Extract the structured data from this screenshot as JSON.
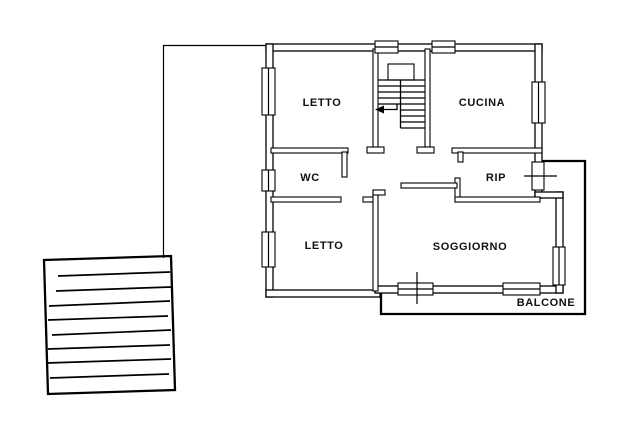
{
  "rooms": [
    {
      "name": "bedroom-1",
      "label": "LETTO"
    },
    {
      "name": "kitchen",
      "label": "CUCINA"
    },
    {
      "name": "bathroom",
      "label": "WC"
    },
    {
      "name": "storage",
      "label": "RIP"
    },
    {
      "name": "bedroom-2",
      "label": "LETTO"
    },
    {
      "name": "living-room",
      "label": "SOGGIORNO"
    },
    {
      "name": "balcony",
      "label": "BALCONE"
    }
  ],
  "colors": {
    "line": "#000000",
    "background": "#ffffff",
    "text": "#111111"
  }
}
